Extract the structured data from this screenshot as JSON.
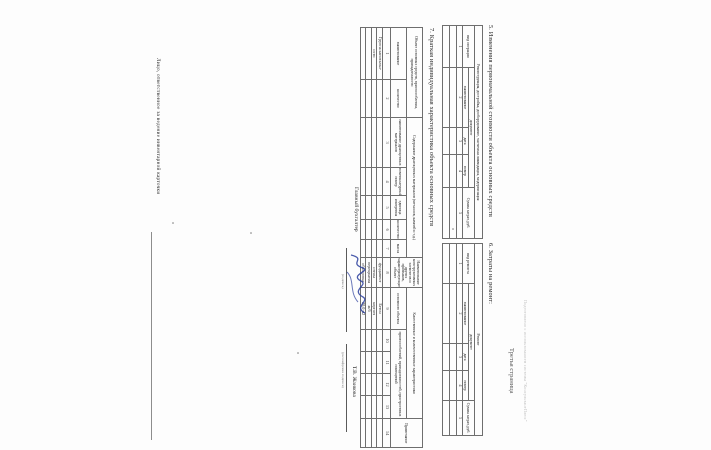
{
  "document": {
    "watermark": "Подготовлено с использованием системы \"КонсультантПлюс\"",
    "page_label": "Третья страница"
  },
  "section5": {
    "title": "5. Изменения первоначальной стоимости объекта основных средств",
    "table": {
      "span_header": "Реконструкция, достройка, дооборудование, частичная ликвидация, модернизация",
      "document_group_header": "документ",
      "col_operation": "вид операции",
      "col_name": "наименование",
      "col_date": "дата",
      "col_number": "номер",
      "col_sum": "Сумма затрат, руб.",
      "column_numbers": [
        "1",
        "2",
        "3",
        "4",
        "5"
      ],
      "empty_row_count": 2
    }
  },
  "section6": {
    "title": "6. Затраты на ремонт:",
    "table": {
      "span_header": "Ремонт",
      "document_group_header": "документ",
      "col_kind": "вид ремонта",
      "col_name": "наименование",
      "col_date": "дата",
      "col_number": "номер",
      "col_sum": "Сумма затрат, руб.",
      "column_numbers": [
        "1",
        "2",
        "3",
        "4",
        "5"
      ],
      "empty_row_count": 2
    }
  },
  "section7": {
    "title": "7. Краткая индивидуальная характеристика объекта основных средств",
    "table": {
      "group_object": "Объект основных средств, приспособления, принадлежности",
      "group_precious": "Содержание драгоценных материалов (металлов, камней и т.д.)",
      "group_elements": "Наименование конструктивных элементов и других признаков, характеризующих объект",
      "group_quality": "Качественные и количественные характеристики",
      "group_note": "Примечание",
      "sub_name": "наименование",
      "sub_qty": "количество",
      "sub_precious_name": "наименование драгоценных материалов",
      "sub_nomenclature": "номенклатурный номер",
      "sub_unit": "единица измерения",
      "sub_qty2": "количество",
      "sub_mass": "масса",
      "sub_main_object": "основного объекта",
      "sub_accessories": "приспособлений, принадлежностей, пристроенных помещений",
      "column_numbers": [
        "1",
        "2",
        "3",
        "4",
        "5",
        "6",
        "7",
        "8",
        "9",
        "10",
        "11",
        "12",
        "13",
        "14"
      ],
      "rows": [
        {
          "object_name": "Группа капитальн-",
          "element": "фундамент",
          "main_value": "Бетон"
        },
        {
          "object_name": "ости",
          "element": "стены",
          "main_value": "кирпич"
        },
        {
          "object_name": "",
          "element": "перекрытия",
          "main_value": "ж/б"
        },
        {
          "object_name": "",
          "element": "облицовка",
          "main_value": "20,0 м2"
        }
      ]
    }
  },
  "signatures": {
    "accountant_label": "Главный бухгалтер",
    "signature_caption": "(подпись)",
    "signer_name": "Т.В. Жаикова",
    "name_caption": "(расшифровка подписи)",
    "keeper_line_label": "Лицо, ответственное за ведение инвентарной карточки"
  }
}
